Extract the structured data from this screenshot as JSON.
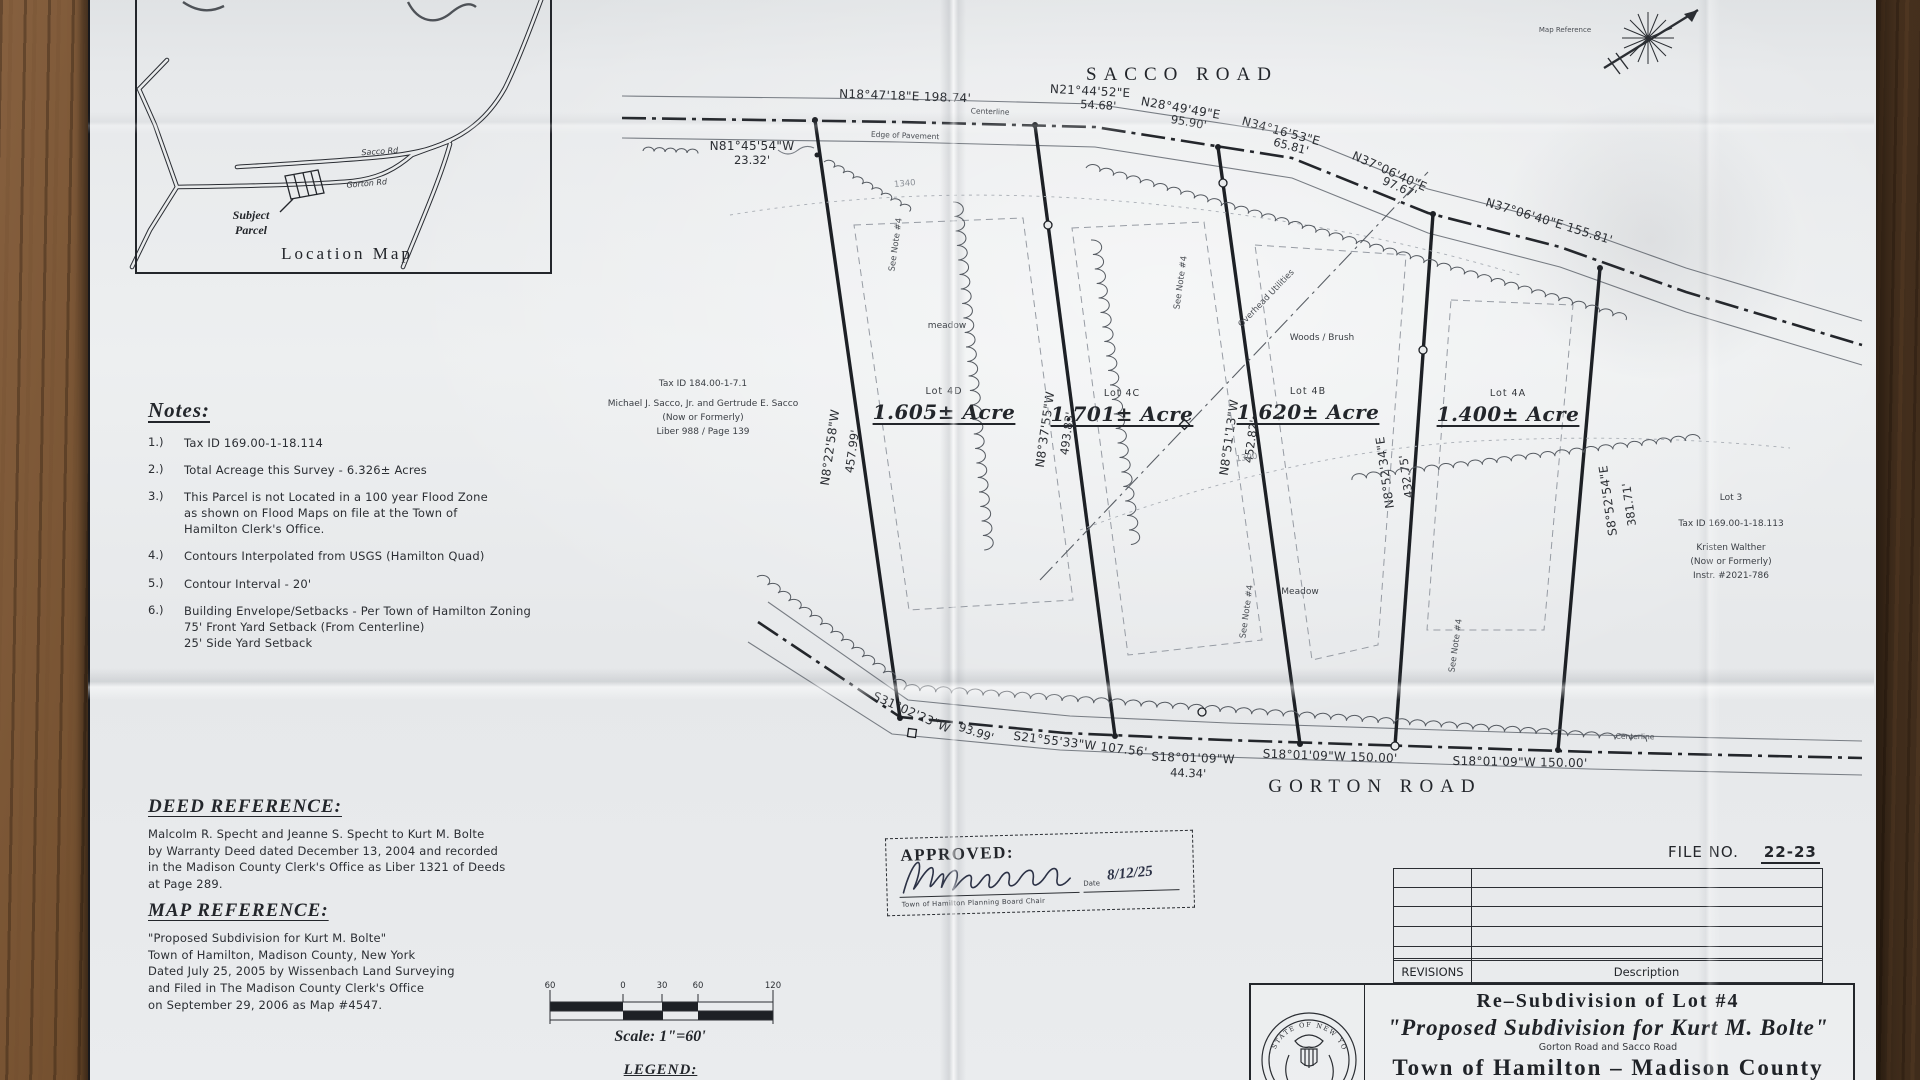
{
  "location_map": {
    "title": "Location Map",
    "subject_parcel": "Subject\nParcel",
    "roads": {
      "sacco": "Sacco Rd",
      "gorton": "Gorton Rd"
    }
  },
  "north_arrow": {
    "caption": "Map Reference"
  },
  "sacco_road": {
    "name": "SACCO ROAD",
    "centerline_label": "Centerline",
    "edge_label": "Edge of Pavement",
    "bearing_1": "N18°47'18\"E  198.74'",
    "bearing_2": "N21°44'52\"E",
    "distance_2": "54.68'",
    "bearing_3": "N28°49'49\"E",
    "distance_3": "95.90'",
    "bearing_4": "N34°16'53\"E",
    "distance_4": "65.81'",
    "bearing_5": "N37°06'40\"E",
    "distance_5": "97.67'",
    "bearing_6": "N37°06'40\"E  155.81'",
    "bearing_7": "N81°45'54\"W",
    "distance_7": "23.32'"
  },
  "gorton_road": {
    "name": "GORTON ROAD",
    "centerline_label": "Centerline",
    "bearing_1": "S31°02'23\"W",
    "distance_1": "93.99'",
    "bearing_2": "S21°55'33\"W  107.56'",
    "bearing_3": "S18°01'09\"W",
    "distance_3": "44.34'",
    "bearing_4": "S18°01'09\"W  150.00'",
    "bearing_5": "S18°01'09\"W  150.00'"
  },
  "lot_lines": {
    "l1_bearing": "N8°22'58\"W",
    "l1_distance": "457.99'",
    "l2_bearing": "N8°37'55\"W",
    "l2_distance": "493.83'",
    "l3_bearing": "N8°51'13\"W",
    "l3_distance": "452.82'",
    "l4_bearing": "N8°52'34\"E",
    "l4_distance": "432.75'",
    "l5_bearing": "S8°52'54\"E",
    "l5_distance": "381.71'"
  },
  "lots": [
    {
      "id": "Lot 4D",
      "area": "1.605± Acre"
    },
    {
      "id": "Lot 4C",
      "area": "1.701± Acre"
    },
    {
      "id": "Lot 4B",
      "area": "1.620± Acre"
    },
    {
      "id": "Lot 4A",
      "area": "1.400± Acre"
    }
  ],
  "annotations": {
    "see_note": "See Note #4",
    "woods_brush": "Woods / Brush",
    "meadow": "Meadow",
    "meadow_small": "meadow",
    "overhead_utilities": "Overhead Utilities",
    "contour_1340": "1340",
    "contour_1300": "1300"
  },
  "adjoiner_north": {
    "line1": "Tax ID 184.00-1-7.1",
    "line2": "Michael J. Sacco, Jr. and Gertrude E. Sacco",
    "line3": "(Now or Formerly)",
    "line4": "Liber 988 / Page 139"
  },
  "adjoiner_east": {
    "line1": "Lot 3",
    "line2": "Tax ID 169.00-1-18.113",
    "line3": "Kristen Walther",
    "line4": "(Now or Formerly)",
    "line5": "Instr. #2021-786"
  },
  "notes": {
    "heading": "Notes:",
    "items": [
      {
        "no": "1.)",
        "text": "Tax ID 169.00-1-18.114"
      },
      {
        "no": "2.)",
        "text": "Total Acreage this Survey - 6.326± Acres"
      },
      {
        "no": "3.)",
        "text": "This Parcel is not Located in a 100 year Flood Zone\nas shown on Flood Maps on file at the Town of\nHamilton Clerk's Office."
      },
      {
        "no": "4.)",
        "text": "Contours Interpolated from USGS (Hamilton Quad)"
      },
      {
        "no": "5.)",
        "text": "Contour Interval - 20'"
      },
      {
        "no": "6.)",
        "text": "Building Envelope/Setbacks - Per Town of Hamilton Zoning\n75' Front Yard Setback (From Centerline)\n25' Side Yard Setback"
      }
    ]
  },
  "deed_reference": {
    "heading": "DEED REFERENCE:",
    "body": "Malcolm R. Specht and Jeanne S. Specht to Kurt M. Bolte\nby Warranty Deed dated December 13, 2004 and recorded\nin the Madison County Clerk's Office as Liber 1321 of Deeds\nat Page 289."
  },
  "map_reference": {
    "heading": "MAP REFERENCE:",
    "body": "\"Proposed Subdivision for Kurt M. Bolte\"\nTown of Hamilton, Madison County, New York\nDated July 25, 2005 by Wissenbach Land Surveying\nand Filed in The Madison County Clerk's Office\non September 29, 2006 as Map #4547."
  },
  "approved": {
    "label": "APPROVED:",
    "date_label": "Date",
    "date_value": "8/12/25",
    "signer_title": "Town of Hamilton Planning Board Chair"
  },
  "file_info": {
    "label": "FILE NO.",
    "number": "22-23"
  },
  "revisions_table": {
    "header_left": "REVISIONS",
    "header_right": "Description"
  },
  "title_block": {
    "line1": "Re–Subdivision of Lot #4",
    "line2": "\"Proposed Subdivision for Kurt M. Bolte\"",
    "line3": "Gorton Road and Sacco Road",
    "line4": "Town of Hamilton – Madison County",
    "seal_text": "STATE OF NEW YORK"
  },
  "scale_bar": {
    "ticks": [
      "60",
      "0",
      "30",
      "60",
      "120"
    ],
    "label": "Scale: 1\"=60'",
    "legend_label": "LEGEND:"
  }
}
